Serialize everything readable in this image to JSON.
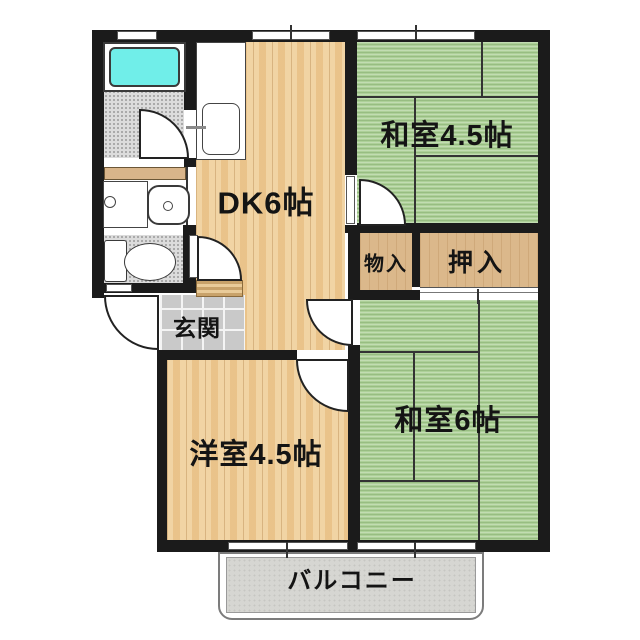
{
  "plan": {
    "type": "apartment-floor-plan",
    "rooms": {
      "dk": {
        "label": "DK6帖",
        "floor": "wood"
      },
      "washitsu_45": {
        "label": "和室4.5帖",
        "floor": "tatami"
      },
      "washitsu_6": {
        "label": "和室6帖",
        "floor": "tatami"
      },
      "youshitsu_45": {
        "label": "洋室4.5帖",
        "floor": "wood"
      },
      "mono_iri": {
        "label": "物入",
        "floor": "wood"
      },
      "oshiire": {
        "label": "押入",
        "floor": "wood"
      },
      "genkan": {
        "label": "玄関",
        "floor": "tile"
      },
      "balcony": {
        "label": "バルコニー",
        "floor": "concrete"
      }
    },
    "fixtures": [
      "bathtub",
      "kitchen-sink",
      "washbasin",
      "washing-machine",
      "toilet",
      "shelf"
    ],
    "colors": {
      "wall": "#1b1b1b",
      "tatami": "#add098",
      "wood": "#f1d4a4",
      "closet": "#dbb88b",
      "bathtub": "#70eee9",
      "tile": "#c9c9c9",
      "balcony": "#d6d6d2"
    }
  }
}
